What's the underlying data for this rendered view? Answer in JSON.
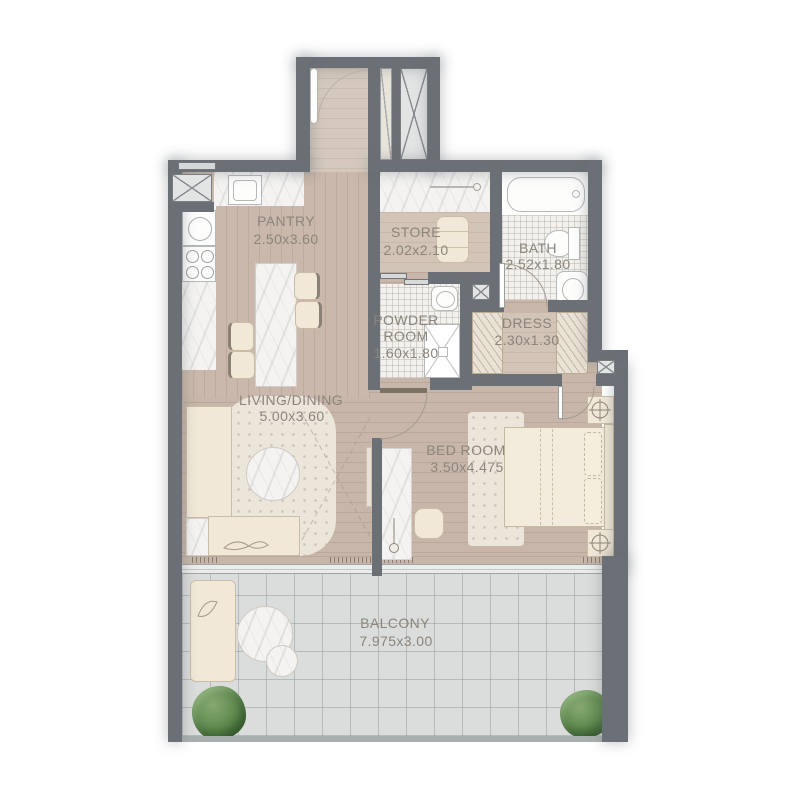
{
  "plan": {
    "rooms": [
      {
        "name": "PANTRY",
        "dims": "2.50x3.60"
      },
      {
        "name": "STORE",
        "dims": "2.02x2.10"
      },
      {
        "name": "BATH",
        "dims": "2.52x1.80"
      },
      {
        "name": "POWDER ROOM",
        "name_lines": [
          "POWDER",
          "ROOM"
        ],
        "dims": "1.60x1.80"
      },
      {
        "name": "DRESS",
        "dims": "2.30x1.30"
      },
      {
        "name": "LIVING/DINING",
        "dims": "5.00x3.60"
      },
      {
        "name": "BED ROOM",
        "dims": "3.50x4.475"
      },
      {
        "name": "BALCONY",
        "dims": "7.975x3.00"
      }
    ],
    "colors": {
      "wall": "#6b7076",
      "wood_floor": "#c7b6a9",
      "balcony_tile": "#dbdddc",
      "marble": "#f4f3f1",
      "furniture_cream": "#f1e8d7",
      "plant_green": "#5d8a4e",
      "label_text": "#8b857c"
    }
  }
}
